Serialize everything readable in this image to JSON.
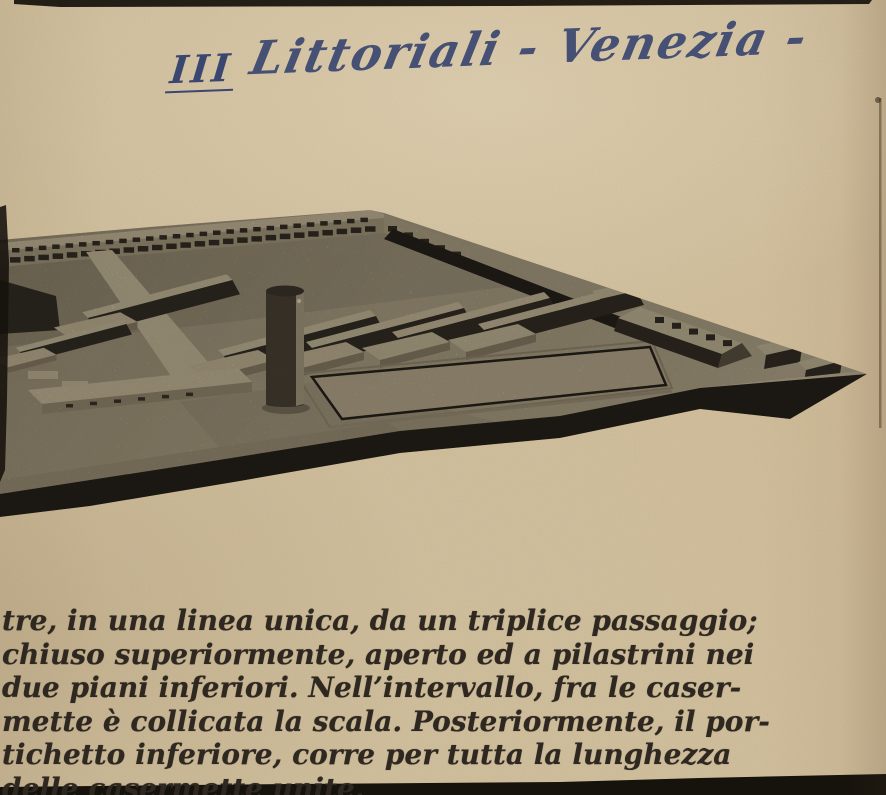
{
  "annotation": {
    "numeral": "III",
    "title": "Littoriali - Venezia -"
  },
  "photo": {
    "description": "Halftone press photograph of an architectural model: a wide low plinth seen in aerial perspective with a long barracks building along the back edge, parallel rows of small barracks blocks, a cylindrical tower, a sunken rectangular court, a hip-roofed pavilion and small blocks near the right corner"
  },
  "caption": {
    "lines": [
      "tre, in una linea unica, da un triplice passaggio;",
      "chiuso superiormente, aperto ed a pilastrini nei",
      "due piani inferiori. Nell’intervallo, fra le caser-",
      "mette è collicata la scala. Posteriormente, il por-",
      "tichetto inferiore, corre per tutta la lunghezza",
      "delle casermette unite."
    ]
  },
  "colors": {
    "paper": "#d6c4a1",
    "ink": "#3d4a75",
    "text": "#2e2821",
    "plat": "#b4a78a",
    "plat_dark": "#a2947a",
    "light": "#ccbe9e",
    "slab": "#c8ba9a",
    "slab_face": "#8d8069",
    "dark": "#352f26",
    "dark2": "#27221b",
    "tower": "#4d4437",
    "edge_black": "#16120c"
  }
}
